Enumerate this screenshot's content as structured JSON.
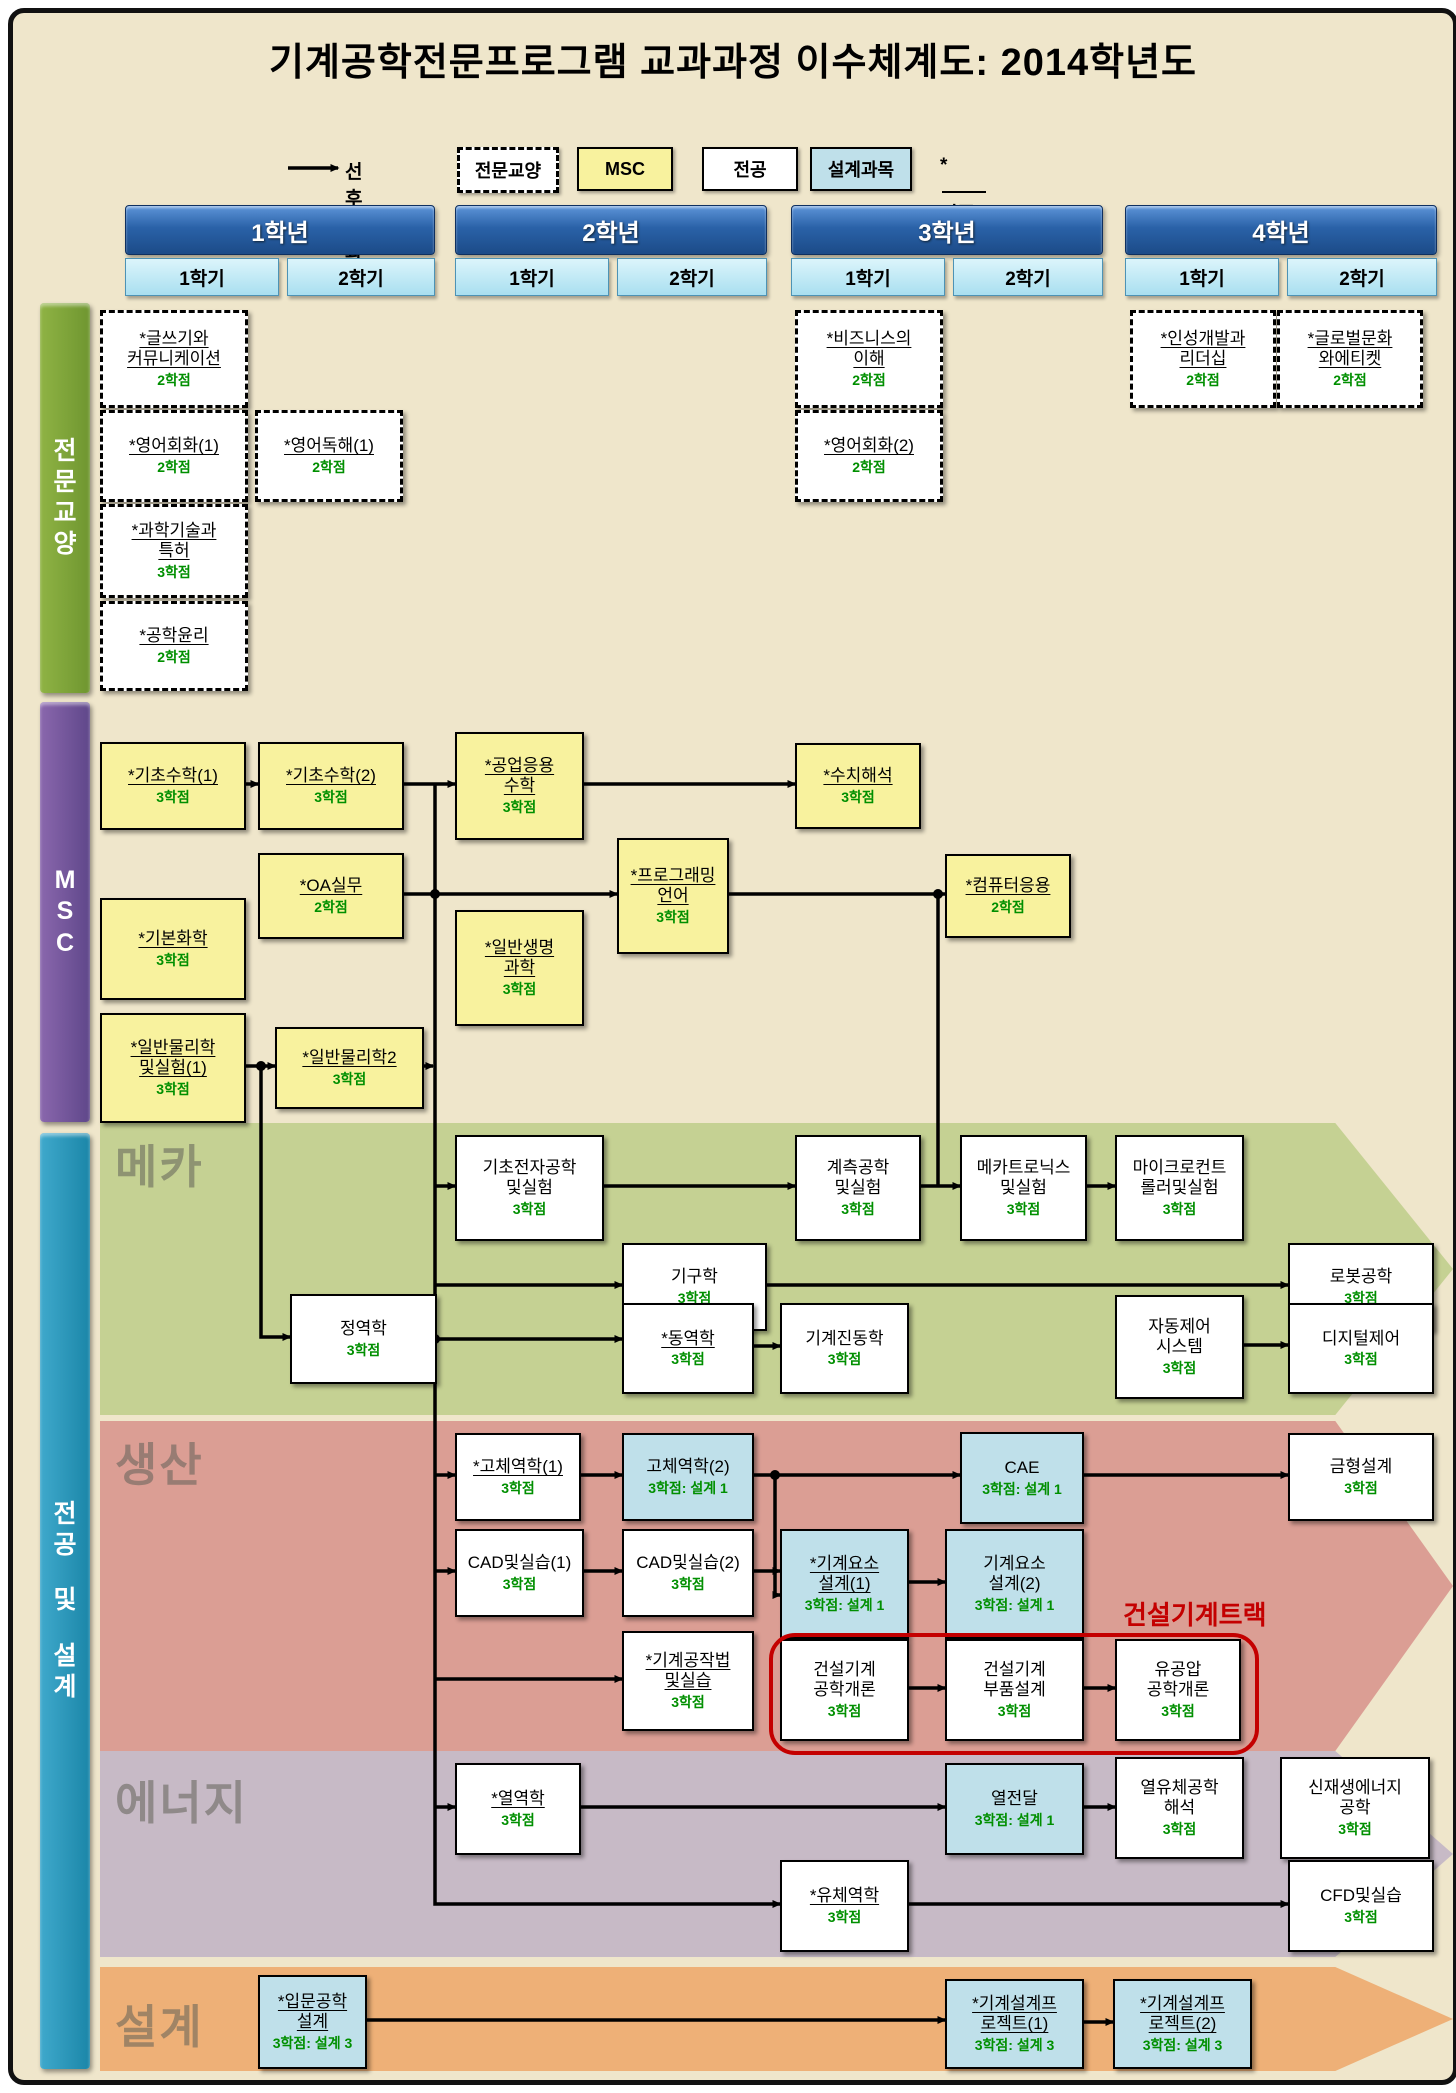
{
  "title": "기계공학전문프로그램 교과과정 이수체계도: 2014학년도",
  "legend": {
    "prereq_label": "선후수과목",
    "liberal_label": "전문교양",
    "msc_label": "MSC",
    "major_label": "전공",
    "design_label": "설계과목",
    "cert_star": "*",
    "cert_label": "인증필수"
  },
  "header": {
    "years": [
      {
        "label": "1학년",
        "x": 120,
        "w": 308,
        "semesters": [
          {
            "label": "1학기",
            "x": 120,
            "w": 152
          },
          {
            "label": "2학기",
            "x": 282,
            "w": 146
          }
        ]
      },
      {
        "label": "2학년",
        "x": 450,
        "w": 310,
        "semesters": [
          {
            "label": "1학기",
            "x": 450,
            "w": 152
          },
          {
            "label": "2학기",
            "x": 612,
            "w": 148
          }
        ]
      },
      {
        "label": "3학년",
        "x": 786,
        "w": 310,
        "semesters": [
          {
            "label": "1학기",
            "x": 786,
            "w": 152
          },
          {
            "label": "2학기",
            "x": 948,
            "w": 148
          }
        ]
      },
      {
        "label": "4학년",
        "x": 1120,
        "w": 310,
        "semesters": [
          {
            "label": "1학기",
            "x": 1120,
            "w": 152
          },
          {
            "label": "2학기",
            "x": 1282,
            "w": 148
          }
        ]
      }
    ]
  },
  "sidebars": [
    {
      "id": "liberal-arts",
      "label": "전문교양",
      "y": 298,
      "h": 390,
      "color1": "#8fb344",
      "color2": "#6f9630"
    },
    {
      "id": "msc",
      "label": "MSC",
      "y": 697,
      "h": 420,
      "color1": "#8a67ad",
      "color2": "#5f478a"
    },
    {
      "id": "major-design",
      "label": "전공 및 설계",
      "y": 1128,
      "h": 936,
      "color1": "#3fa9cc",
      "color2": "#1b86a8"
    }
  ],
  "bands": [
    {
      "id": "mechatronics",
      "label": "메카",
      "y": 1118,
      "h": 292,
      "label_top": 8,
      "color": "#c5d193"
    },
    {
      "id": "production",
      "label": "생산",
      "y": 1416,
      "h": 330,
      "label_top": 8,
      "color": "#db9e94"
    },
    {
      "id": "energy",
      "label": "에너지",
      "y": 1746,
      "h": 206,
      "label_top": 16,
      "color": "#c7bac6"
    },
    {
      "id": "design",
      "label": "설계",
      "y": 1962,
      "h": 104,
      "label_top": 24,
      "color": "#eeb077"
    }
  ],
  "track": {
    "label": "건설기계트랙",
    "rect": {
      "x": 764,
      "y": 1628,
      "w": 482,
      "h": 114
    },
    "label_x": 1118,
    "label_y": 1590
  },
  "courses": [
    {
      "id": "writing-communication",
      "kind": "dashed",
      "x": 95,
      "y": 305,
      "w": 142,
      "h": 92,
      "lines": [
        "*글쓰기와",
        "커뮤니케이션"
      ],
      "credit": "2학점"
    },
    {
      "id": "english-conv-1",
      "kind": "dashed",
      "x": 95,
      "y": 405,
      "w": 142,
      "h": 86,
      "lines": [
        "*영어회화(1)"
      ],
      "credit": "2학점"
    },
    {
      "id": "english-reading-1",
      "kind": "dashed",
      "x": 250,
      "y": 405,
      "w": 142,
      "h": 86,
      "lines": [
        "*영어독해(1)"
      ],
      "credit": "2학점"
    },
    {
      "id": "science-tech-patent",
      "kind": "dashed",
      "x": 95,
      "y": 499,
      "w": 142,
      "h": 88,
      "lines": [
        "*과학기술과",
        "특허"
      ],
      "credit": "3학점"
    },
    {
      "id": "engineering-ethics",
      "kind": "dashed",
      "x": 95,
      "y": 596,
      "w": 142,
      "h": 84,
      "lines": [
        "*공학윤리"
      ],
      "credit": "2학점"
    },
    {
      "id": "business-understanding",
      "kind": "dashed",
      "x": 790,
      "y": 305,
      "w": 142,
      "h": 92,
      "lines": [
        "*비즈니스의",
        "이해"
      ],
      "credit": "2학점"
    },
    {
      "id": "english-conv-2",
      "kind": "dashed",
      "x": 790,
      "y": 405,
      "w": 142,
      "h": 86,
      "lines": [
        "*영어회화(2)"
      ],
      "credit": "2학점"
    },
    {
      "id": "personality-leadership",
      "kind": "dashed",
      "x": 1125,
      "y": 305,
      "w": 140,
      "h": 92,
      "lines": [
        "*인성개발과",
        "리더십"
      ],
      "credit": "2학점"
    },
    {
      "id": "global-culture-etiquette",
      "kind": "dashed",
      "x": 1272,
      "y": 305,
      "w": 140,
      "h": 92,
      "lines": [
        "*글로벌문화",
        "와에티켓"
      ],
      "credit": "2학점"
    },
    {
      "id": "basic-math-1",
      "kind": "msc",
      "x": 95,
      "y": 737,
      "w": 142,
      "h": 84,
      "lines": [
        "*기초수학(1)"
      ],
      "credit": "3학점"
    },
    {
      "id": "basic-math-2",
      "kind": "msc",
      "x": 253,
      "y": 737,
      "w": 142,
      "h": 84,
      "lines": [
        "*기초수학(2)"
      ],
      "credit": "3학점"
    },
    {
      "id": "engineering-math",
      "kind": "msc",
      "x": 450,
      "y": 727,
      "w": 125,
      "h": 104,
      "lines": [
        "*공업응용",
        "수학"
      ],
      "credit": "3학점"
    },
    {
      "id": "numerical-analysis",
      "kind": "msc",
      "x": 790,
      "y": 738,
      "w": 122,
      "h": 82,
      "lines": [
        "*수치해석"
      ],
      "credit": "3학점"
    },
    {
      "id": "oa-practice",
      "kind": "msc",
      "x": 253,
      "y": 848,
      "w": 142,
      "h": 82,
      "lines": [
        "*OA실무"
      ],
      "credit": "2학점"
    },
    {
      "id": "programming-language",
      "kind": "msc",
      "x": 612,
      "y": 833,
      "w": 108,
      "h": 112,
      "lines": [
        "*프로그래밍",
        "언어"
      ],
      "credit": "3학점"
    },
    {
      "id": "computer-application",
      "kind": "msc",
      "x": 940,
      "y": 849,
      "w": 122,
      "h": 80,
      "lines": [
        "*컴퓨터응용"
      ],
      "credit": "2학점"
    },
    {
      "id": "general-life-science",
      "kind": "msc",
      "x": 450,
      "y": 905,
      "w": 125,
      "h": 112,
      "lines": [
        "*일반생명",
        "과학"
      ],
      "credit": "3학점"
    },
    {
      "id": "basic-chemistry",
      "kind": "msc",
      "x": 95,
      "y": 893,
      "w": 142,
      "h": 98,
      "lines": [
        "*기본화학"
      ],
      "credit": "3학점"
    },
    {
      "id": "general-physics-lab-1",
      "kind": "msc",
      "x": 95,
      "y": 1008,
      "w": 142,
      "h": 106,
      "lines": [
        "*일반물리학",
        "및실험(1)"
      ],
      "credit": "3학점"
    },
    {
      "id": "general-physics-2",
      "kind": "msc",
      "x": 270,
      "y": 1022,
      "w": 145,
      "h": 78,
      "lines": [
        "*일반물리학2"
      ],
      "credit": "3학점"
    },
    {
      "id": "basic-electronics-lab",
      "kind": "major",
      "x": 450,
      "y": 1130,
      "w": 145,
      "h": 102,
      "lines": [
        "기초전자공학",
        "및실험"
      ],
      "credit": "3학점"
    },
    {
      "id": "instrumentation-lab",
      "kind": "major",
      "x": 790,
      "y": 1130,
      "w": 122,
      "h": 102,
      "lines": [
        "계측공학",
        "및실험"
      ],
      "credit": "3학점"
    },
    {
      "id": "mechatronics-lab",
      "kind": "major",
      "x": 955,
      "y": 1130,
      "w": 123,
      "h": 102,
      "lines": [
        "메카트로닉스",
        "및실험"
      ],
      "credit": "3학점"
    },
    {
      "id": "microcontroller-lab",
      "kind": "major",
      "x": 1110,
      "y": 1130,
      "w": 125,
      "h": 102,
      "lines": [
        "마이크로컨트",
        "롤러및실험"
      ],
      "credit": "3학점"
    },
    {
      "id": "mechanisms",
      "kind": "major",
      "x": 617,
      "y": 1238,
      "w": 141,
      "h": 84,
      "lines": [
        "기구학"
      ],
      "credit": "3학점"
    },
    {
      "id": "robotics",
      "kind": "major",
      "x": 1283,
      "y": 1238,
      "w": 142,
      "h": 84,
      "lines": [
        "로봇공학"
      ],
      "credit": "3학점"
    },
    {
      "id": "statics",
      "kind": "major",
      "x": 285,
      "y": 1289,
      "w": 143,
      "h": 86,
      "lines": [
        "정역학"
      ],
      "credit": "3학점"
    },
    {
      "id": "dynamics",
      "kind": "major",
      "x": 617,
      "y": 1298,
      "w": 128,
      "h": 87,
      "lines": [
        "*동역학"
      ],
      "credit": "3학점"
    },
    {
      "id": "mechanical-vibrations",
      "kind": "major",
      "x": 775,
      "y": 1298,
      "w": 125,
      "h": 87,
      "lines": [
        "기계진동학"
      ],
      "credit": "3학점"
    },
    {
      "id": "automatic-control-systems",
      "kind": "major",
      "x": 1110,
      "y": 1290,
      "w": 125,
      "h": 100,
      "lines": [
        "자동제어",
        "시스템"
      ],
      "credit": "3학점"
    },
    {
      "id": "digital-control",
      "kind": "major",
      "x": 1283,
      "y": 1298,
      "w": 142,
      "h": 87,
      "lines": [
        "디지털제어"
      ],
      "credit": "3학점"
    },
    {
      "id": "solid-mechanics-1",
      "kind": "major",
      "x": 450,
      "y": 1428,
      "w": 122,
      "h": 84,
      "lines": [
        "*고체역학(1)"
      ],
      "credit": "3학점"
    },
    {
      "id": "solid-mechanics-2",
      "kind": "design",
      "x": 617,
      "y": 1428,
      "w": 128,
      "h": 84,
      "lines": [
        "고체역학(2)"
      ],
      "credit": "3학점: 설계 1"
    },
    {
      "id": "cae",
      "kind": "design",
      "x": 955,
      "y": 1427,
      "w": 120,
      "h": 88,
      "lines": [
        "CAE"
      ],
      "credit": "3학점: 설계 1"
    },
    {
      "id": "mold-design",
      "kind": "major",
      "x": 1283,
      "y": 1428,
      "w": 142,
      "h": 84,
      "lines": [
        "금형설계"
      ],
      "credit": "3학점"
    },
    {
      "id": "cad-practice-1",
      "kind": "major",
      "x": 450,
      "y": 1524,
      "w": 125,
      "h": 84,
      "lines": [
        "CAD및실습(1)"
      ],
      "credit": "3학점"
    },
    {
      "id": "cad-practice-2",
      "kind": "major",
      "x": 617,
      "y": 1524,
      "w": 128,
      "h": 84,
      "lines": [
        "CAD및실습(2)"
      ],
      "credit": "3학점"
    },
    {
      "id": "machine-element-design-1",
      "kind": "design",
      "x": 775,
      "y": 1524,
      "w": 125,
      "h": 106,
      "lines": [
        "*기계요소",
        "설계(1)"
      ],
      "credit": "3학점: 설계 1"
    },
    {
      "id": "machine-element-design-2",
      "kind": "design",
      "x": 940,
      "y": 1524,
      "w": 135,
      "h": 106,
      "lines": [
        "기계요소",
        "설계(2)"
      ],
      "credit": "3학점: 설계 1"
    },
    {
      "id": "machine-shop-practice",
      "kind": "major",
      "x": 617,
      "y": 1626,
      "w": 128,
      "h": 96,
      "lines": [
        "*기계공작법",
        "및실습"
      ],
      "credit": "3학점"
    },
    {
      "id": "construction-machinery-intro",
      "kind": "major",
      "x": 775,
      "y": 1634,
      "w": 125,
      "h": 98,
      "lines": [
        "건설기계",
        "공학개론"
      ],
      "credit": "3학점"
    },
    {
      "id": "construction-machinery-parts",
      "kind": "major",
      "x": 940,
      "y": 1634,
      "w": 135,
      "h": 98,
      "lines": [
        "건설기계",
        "부품설계"
      ],
      "credit": "3학점"
    },
    {
      "id": "hydraulics-pneumatics-intro",
      "kind": "major",
      "x": 1110,
      "y": 1634,
      "w": 122,
      "h": 98,
      "lines": [
        "유공압",
        "공학개론"
      ],
      "credit": "3학점"
    },
    {
      "id": "thermodynamics",
      "kind": "major",
      "x": 450,
      "y": 1758,
      "w": 122,
      "h": 88,
      "lines": [
        "*열역학"
      ],
      "credit": "3학점"
    },
    {
      "id": "heat-transfer",
      "kind": "design",
      "x": 940,
      "y": 1758,
      "w": 135,
      "h": 88,
      "lines": [
        "열전달"
      ],
      "credit": "3학점: 설계 1"
    },
    {
      "id": "thermofluid-analysis",
      "kind": "major",
      "x": 1110,
      "y": 1752,
      "w": 125,
      "h": 98,
      "lines": [
        "열유체공학",
        "해석"
      ],
      "credit": "3학점"
    },
    {
      "id": "renewable-energy",
      "kind": "major",
      "x": 1275,
      "y": 1752,
      "w": 146,
      "h": 98,
      "lines": [
        "신재생에너지",
        "공학"
      ],
      "credit": "3학점"
    },
    {
      "id": "fluid-mechanics",
      "kind": "major",
      "x": 775,
      "y": 1855,
      "w": 125,
      "h": 88,
      "lines": [
        "*유체역학"
      ],
      "credit": "3학점"
    },
    {
      "id": "cfd-practice",
      "kind": "major",
      "x": 1283,
      "y": 1855,
      "w": 142,
      "h": 88,
      "lines": [
        "CFD및실습"
      ],
      "credit": "3학점"
    },
    {
      "id": "intro-engineering-design",
      "kind": "design",
      "x": 253,
      "y": 1970,
      "w": 105,
      "h": 90,
      "lines": [
        "*입문공학",
        "설계"
      ],
      "credit": "3학점: 설계 3"
    },
    {
      "id": "mech-design-project-1",
      "kind": "design",
      "x": 940,
      "y": 1974,
      "w": 135,
      "h": 86,
      "lines": [
        "*기계설계프",
        "로젝트(1)"
      ],
      "credit": "3학점: 설계 3"
    },
    {
      "id": "mech-design-project-2",
      "kind": "design",
      "x": 1108,
      "y": 1974,
      "w": 135,
      "h": 86,
      "lines": [
        "*기계설계프",
        "로젝트(2)"
      ],
      "credit": "3학점: 설계 3"
    }
  ],
  "edges": [
    {
      "pts": [
        [
          283,
          163
        ],
        [
          333,
          163
        ]
      ],
      "arrow": true
    },
    {
      "pts": [
        [
          237,
          779
        ],
        [
          253,
          779
        ]
      ],
      "arrow": true
    },
    {
      "pts": [
        [
          395,
          779
        ],
        [
          450,
          779
        ]
      ],
      "arrow": true
    },
    {
      "pts": [
        [
          575,
          779
        ],
        [
          790,
          779
        ]
      ],
      "arrow": true
    },
    {
      "pts": [
        [
          430,
          779
        ],
        [
          430,
          1899
        ],
        [
          775,
          1899
        ]
      ],
      "arrow": true
    },
    {
      "pts": [
        [
          395,
          889
        ],
        [
          612,
          889
        ]
      ],
      "arrow": true
    },
    {
      "pts": [
        [
          720,
          889
        ],
        [
          940,
          889
        ]
      ],
      "arrow": true
    },
    {
      "pts": [
        [
          933,
          889
        ],
        [
          933,
          1181
        ]
      ],
      "arrow": false
    },
    {
      "pts": [
        [
          237,
          1061
        ],
        [
          270,
          1061
        ]
      ],
      "arrow": true
    },
    {
      "pts": [
        [
          256,
          1061
        ],
        [
          256,
          1332
        ],
        [
          285,
          1332
        ]
      ],
      "arrow": true
    },
    {
      "pts": [
        [
          415,
          1061
        ],
        [
          428,
          1061
        ]
      ],
      "arrow": true
    },
    {
      "pts": [
        [
          430,
          1181
        ],
        [
          450,
          1181
        ]
      ],
      "arrow": true
    },
    {
      "pts": [
        [
          595,
          1181
        ],
        [
          790,
          1181
        ]
      ],
      "arrow": true
    },
    {
      "pts": [
        [
          912,
          1181
        ],
        [
          955,
          1181
        ]
      ],
      "arrow": true
    },
    {
      "pts": [
        [
          1078,
          1181
        ],
        [
          1110,
          1181
        ]
      ],
      "arrow": true
    },
    {
      "pts": [
        [
          430,
          1280
        ],
        [
          617,
          1280
        ]
      ],
      "arrow": true
    },
    {
      "pts": [
        [
          758,
          1280
        ],
        [
          1283,
          1280
        ]
      ],
      "arrow": true
    },
    {
      "pts": [
        [
          428,
          1334
        ],
        [
          617,
          1334
        ]
      ],
      "arrow": true
    },
    {
      "pts": [
        [
          745,
          1341
        ],
        [
          775,
          1341
        ]
      ],
      "arrow": true
    },
    {
      "pts": [
        [
          1235,
          1340
        ],
        [
          1283,
          1340
        ]
      ],
      "arrow": true
    },
    {
      "pts": [
        [
          430,
          1470
        ],
        [
          450,
          1470
        ]
      ],
      "arrow": true
    },
    {
      "pts": [
        [
          572,
          1470
        ],
        [
          617,
          1470
        ]
      ],
      "arrow": true
    },
    {
      "pts": [
        [
          745,
          1470
        ],
        [
          955,
          1470
        ]
      ],
      "arrow": true
    },
    {
      "pts": [
        [
          770,
          1470
        ],
        [
          770,
          1590
        ],
        [
          775,
          1590
        ]
      ],
      "arrow": true
    },
    {
      "pts": [
        [
          745,
          1566
        ],
        [
          775,
          1566
        ]
      ],
      "arrow": true
    },
    {
      "pts": [
        [
          1075,
          1470
        ],
        [
          1283,
          1470
        ]
      ],
      "arrow": true
    },
    {
      "pts": [
        [
          430,
          1566
        ],
        [
          450,
          1566
        ]
      ],
      "arrow": true
    },
    {
      "pts": [
        [
          575,
          1566
        ],
        [
          617,
          1566
        ]
      ],
      "arrow": true
    },
    {
      "pts": [
        [
          900,
          1577
        ],
        [
          940,
          1577
        ]
      ],
      "arrow": true
    },
    {
      "pts": [
        [
          430,
          1674
        ],
        [
          617,
          1674
        ]
      ],
      "arrow": true
    },
    {
      "pts": [
        [
          900,
          1683
        ],
        [
          940,
          1683
        ]
      ],
      "arrow": true
    },
    {
      "pts": [
        [
          1075,
          1683
        ],
        [
          1110,
          1683
        ]
      ],
      "arrow": true
    },
    {
      "pts": [
        [
          430,
          1802
        ],
        [
          450,
          1802
        ]
      ],
      "arrow": true
    },
    {
      "pts": [
        [
          572,
          1802
        ],
        [
          940,
          1802
        ]
      ],
      "arrow": true
    },
    {
      "pts": [
        [
          1075,
          1802
        ],
        [
          1110,
          1802
        ]
      ],
      "arrow": true
    },
    {
      "pts": [
        [
          900,
          1899
        ],
        [
          1283,
          1899
        ]
      ],
      "arrow": true
    },
    {
      "pts": [
        [
          358,
          2015
        ],
        [
          940,
          2015
        ]
      ],
      "arrow": true
    },
    {
      "pts": [
        [
          1075,
          2017
        ],
        [
          1108,
          2017
        ]
      ],
      "arrow": true
    }
  ],
  "dots": [
    [
      430,
      889
    ],
    [
      933,
      889
    ],
    [
      256,
      1061
    ],
    [
      430,
      1334
    ],
    [
      770,
      1470
    ]
  ]
}
